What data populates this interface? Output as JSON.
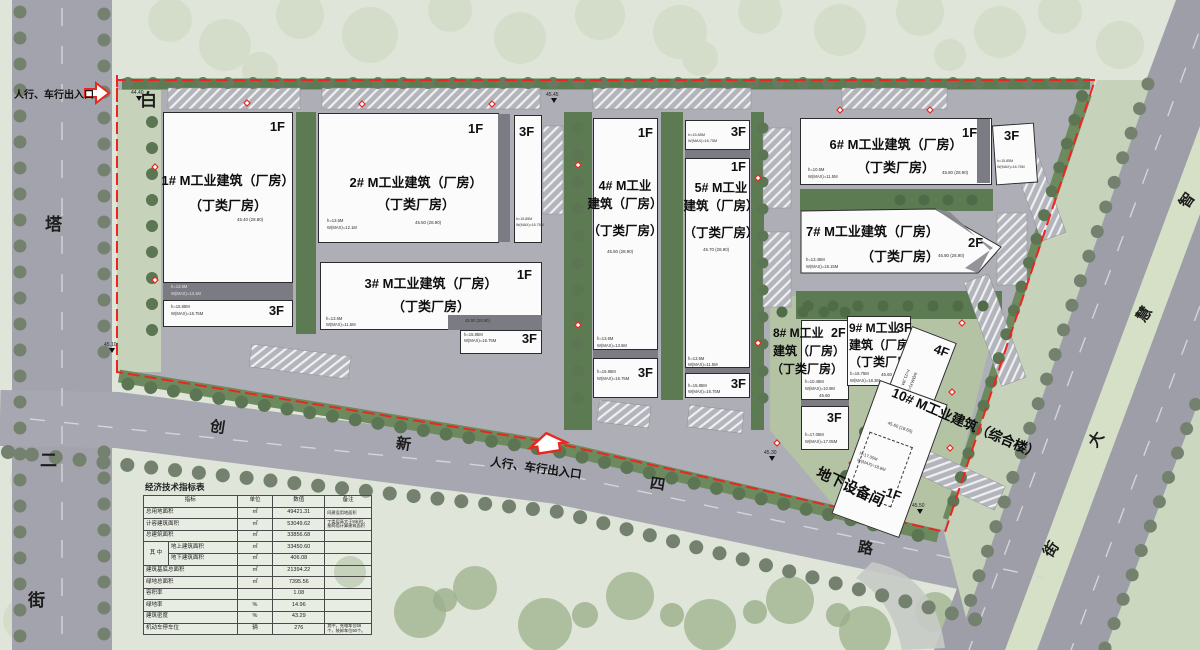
{
  "colors": {
    "boundary_red": "#e8281e",
    "road_gray": "#a4a5ae",
    "lawn": "#dfe5d8",
    "green_band": "#5d7b52",
    "building_white": "#fbfbfb"
  },
  "entrances": {
    "top": "人行、车行出入口",
    "bottom": "人行、车行出入口"
  },
  "streets": {
    "left": [
      "白",
      "塔",
      "二",
      "街"
    ],
    "bottom": [
      "创",
      "新",
      "四",
      "路"
    ],
    "right": [
      "智",
      "慧",
      "大",
      "街"
    ]
  },
  "misc": {
    "basement": "地下设备间"
  },
  "spots": [
    {
      "v": "44.40"
    },
    {
      "v": "45.45"
    },
    {
      "v": "45.10"
    },
    {
      "v": "45.30"
    },
    {
      "v": "45.50"
    }
  ],
  "buildings": [
    {
      "lines": [
        "1# M工业建筑（厂房）",
        "（丁类厂房）"
      ],
      "floors": [
        "1F",
        "3F"
      ],
      "elev": "45.40 (28.80)",
      "anns": [
        "h=13.6M",
        "W(MAX)=13.1M",
        "h=15.85M",
        "W(MAX)=16.75M"
      ]
    },
    {
      "lines": [
        "2# M工业建筑（厂房）",
        "（丁类厂房）"
      ],
      "floors": [
        "1F",
        "3F"
      ],
      "elev": "45.50 (28.90)",
      "anns": [
        "h=13.6M",
        "W(MAX)=12.1M",
        "h=15.85M",
        "W(MAX)=16.75M"
      ]
    },
    {
      "lines": [
        "3# M工业建筑（厂房）",
        "（丁类厂房）"
      ],
      "floors": [
        "1F",
        "3F"
      ],
      "elev": "45.50 (28.90)",
      "anns": [
        "h=13.6M",
        "W(MAX)=11.5M",
        "h=15.85M",
        "W(MAX)=16.75M"
      ]
    },
    {
      "lines": [
        "4# M工业",
        "建筑（厂房）",
        "（丁类厂房）"
      ],
      "floors": [
        "1F",
        "3F"
      ],
      "elev": "45.50 (28.90)",
      "anns": [
        "h=13.6M",
        "W(MAX)=13.6M",
        "h=15.85M",
        "W(MAX)=16.75M"
      ]
    },
    {
      "lines": [
        "5# M工业",
        "建筑（厂房）",
        "（丁类厂房）"
      ],
      "floors": [
        "3F",
        "1F",
        "3F"
      ],
      "elev": "45.70 (28.90)",
      "anns": [
        "h=15.85M",
        "W(MAX)=16.75M",
        "h=13.6M",
        "W(MAX)=11.5M",
        "h=15.85M",
        "W(MAX)=16.75M"
      ]
    },
    {
      "lines": [
        "6# M工业建筑（厂房）",
        "（丁类厂房）"
      ],
      "floors": [
        "1F",
        "3F"
      ],
      "elev": "45.80 (28.90)",
      "anns": [
        "h=10.6M",
        "W(MAX)=11.5M",
        "h=15.85M",
        "W(MAX)=16.75M"
      ]
    },
    {
      "lines": [
        "7# M工业建筑（厂房）",
        "（丁类厂房）"
      ],
      "floors": [
        "2F"
      ],
      "elev": "45.80 (28.90)",
      "anns": [
        "h=13.45M",
        "W(MAX)=15.15M"
      ]
    },
    {
      "lines": [
        "8# M工业",
        "建筑（厂房）",
        "（丁类厂房）"
      ],
      "floors": [
        "2F",
        "3F"
      ],
      "elev": "45.60",
      "anns": [
        "h=10.45M",
        "W(MAX)=10.9M",
        "h=17.05M",
        "W(MAX)=17.05M"
      ]
    },
    {
      "lines": [
        "9# M工业",
        "建筑（厂房）",
        "（丁类厂房）"
      ],
      "floors": [
        "3F"
      ],
      "elev": "45.60",
      "anns": [
        "h=16.75M",
        "W(MAX)=18.3M"
      ]
    },
    {
      "lines": [
        "10# M工业建筑（综合楼）"
      ],
      "floors": [
        "4F",
        "-1F"
      ],
      "elev": "45.60 (18.60)",
      "anns": [
        "h=17.05M",
        "W(MAX)=18.8M"
      ],
      "anns4f": [
        "h=21.3M",
        "W(MAX)=21.8M"
      ]
    }
  ],
  "table": {
    "title": "经济技术指标表",
    "headers": [
      "指标",
      "单位",
      "数值",
      "备注"
    ],
    "merge": "其 中",
    "rows": [
      {
        "label": "总用地面积",
        "unit": "㎡",
        "value": "49421.31",
        "note": "同建设用地面积"
      },
      {
        "label": "计容建筑面积",
        "unit": "㎡",
        "value": "53049.62",
        "note": "丁类层高大于8米时，按两倍计算建筑面积"
      },
      {
        "label": "总建筑面积",
        "unit": "㎡",
        "value": "33856.68",
        "note": ""
      },
      {
        "label": "地上建筑面积",
        "unit": "㎡",
        "value": "33450.60",
        "note": ""
      },
      {
        "label": "地下建筑面积",
        "unit": "㎡",
        "value": "406.08",
        "note": ""
      },
      {
        "label": "建筑基底总面积",
        "unit": "㎡",
        "value": "21394.22",
        "note": ""
      },
      {
        "label": "绿地总面积",
        "unit": "㎡",
        "value": "7395.56",
        "note": ""
      },
      {
        "label": "容积率",
        "unit": "",
        "value": "1.08",
        "note": ""
      },
      {
        "label": "绿地率",
        "unit": "%",
        "value": "14.96",
        "note": ""
      },
      {
        "label": "建筑密度",
        "unit": "%",
        "value": "43.29",
        "note": ""
      },
      {
        "label": "机动车停车位",
        "unit": "辆",
        "value": "276",
        "note": "其中，充电车位56个，装卸车位50个。"
      }
    ]
  }
}
